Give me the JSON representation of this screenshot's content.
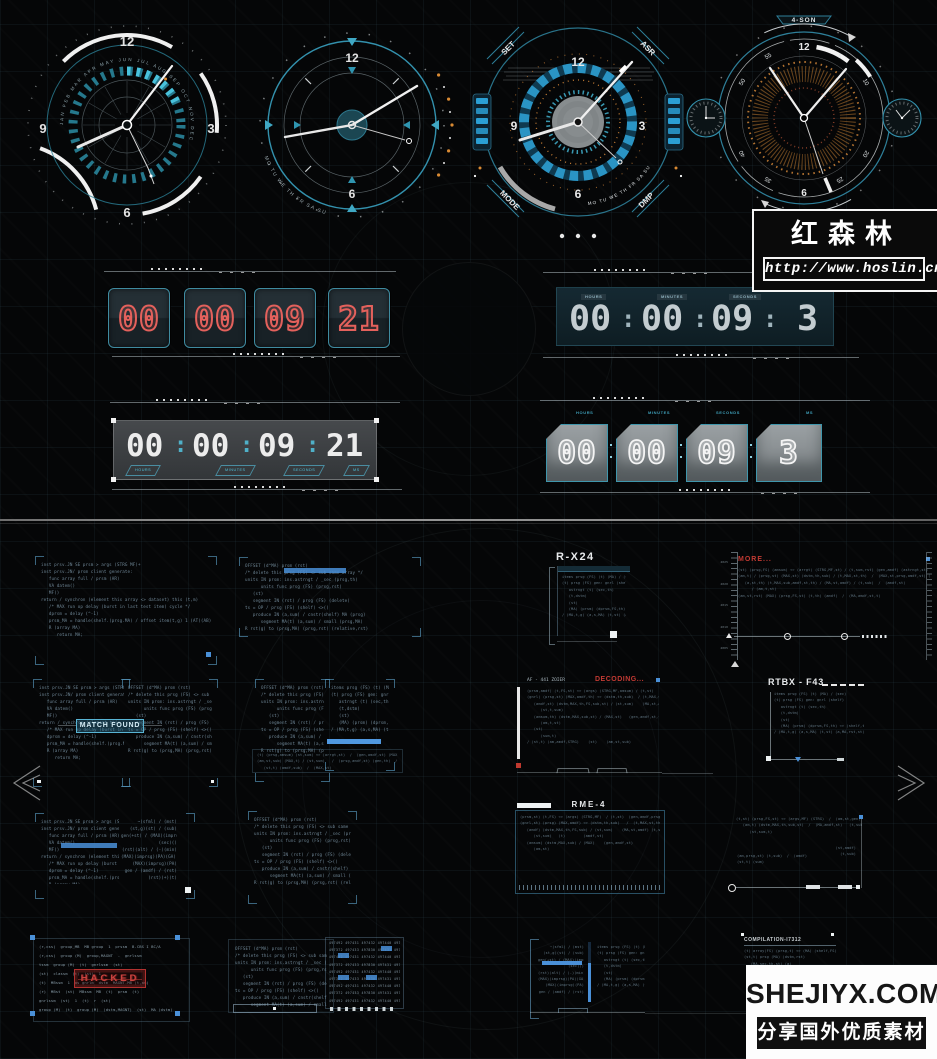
{
  "colors": {
    "accent_teal": "#35a0bc",
    "accent_blue": "#4a90d8",
    "digit_red": "#e4615c",
    "title_red": "#c23a33",
    "panel_border": "#2e6e8e",
    "background": "#050607"
  },
  "watermark_hoslin": {
    "title": "红森林",
    "url": "http://www.hoslin.cn/"
  },
  "watermark_shejiyx": {
    "site": "SHEJIYX.COM",
    "tagline": "分享国外优质素材"
  },
  "clocks": {
    "c1": {
      "n12": "12",
      "n3": "3",
      "n6": "6",
      "n9": "9",
      "months": "JAN FEB MAR APR MAY JUN JUL AUG SEP OCT NOV DEC"
    },
    "c2": {
      "n12": "12",
      "n6": "6",
      "days": "MO TU WE TH FR SA SU"
    },
    "c3": {
      "n12": "12",
      "n3": "3",
      "n6": "6",
      "n9": "9",
      "tab_tl": "SET",
      "tab_tr": "ASR",
      "tab_bl": "MODE",
      "tab_br": "DMP",
      "days": "MO TU WE TH FR SA SU"
    },
    "c4": {
      "top": "4-SON",
      "bottom": "AUTO WGT",
      "n12": "12",
      "n6": "6",
      "m5": "5",
      "m10": "10",
      "m20": "20",
      "m25": "25",
      "m35": "35",
      "m40": "40",
      "m50": "50",
      "m55": "55"
    }
  },
  "timers": {
    "flip_red": {
      "d1": "00",
      "d2": "00",
      "d3": "09",
      "d4": "21"
    },
    "digital_teal": {
      "l1": "HOURS",
      "l2": "MINUTES",
      "l3": "SECONDS",
      "d1": "00",
      "d2": "00",
      "d3": "09",
      "d4": "3",
      "colon": ":"
    },
    "digital_gray": {
      "l1": "HOURS",
      "l2": "MINUTES",
      "l3": "SECONDS",
      "l4": "MS",
      "d1": "00",
      "d2": "00",
      "d3": "09",
      "d4": "21",
      "colon": ":"
    },
    "flip_gray": {
      "l1": "HOURS",
      "l2": "MINUTES",
      "l3": "SECONDS",
      "l4": "MS",
      "d1": "00",
      "d2": "00",
      "d3": "09",
      "d4": "3"
    }
  },
  "labels": {
    "rx24": "R-X24",
    "more": "MORE...",
    "match": "MATCH FOUND",
    "af": "AF - 441 ZOIER",
    "decoding": "DECODING...",
    "rtbx": "RTBX - F43",
    "rme": "RME-4",
    "comp": "COMPILATION-I7312",
    "hacked": "HACKED"
  },
  "ruler": {
    "labels": [
      "4025",
      "4020",
      "4015",
      "4010",
      "4005"
    ]
  },
  "code": {
    "a": [
      "inst prsv.JN SE prsm > args (STRG MF)+",
      "inst prsv.JN/ prsm client generate:",
      "   func array full / prsm (AR)",
      "   VA datem()",
      "   MF()",
      "return / synchron (element this array <> dataset) this (t,m)",
      "   /* MAX run op delay (burst in last test item) cycle */",
      "   dprsm = delay (^-1)",
      "   prsm_MA = handle(shelf.(prsg.MA) / offset item(t,g) 1 (AT)(AB)",
      "   R (array MA)",
      "      return MA;"
    ],
    "b": [
      "OFFSET (d^MA) prsm (rst)",
      "/* delete this prsg (FS) <> sub same array */",
      "units IN prsm: ins.astrngt / _sec (prsg,th)",
      "      units func prsg (FS) (prsg,rst)",
      "   (st)",
      "   segment IN (rst) / prsg (FS) (delete)",
      "ts = OP / prsg (FS) (shelf) <>()",
      "   produce IN (a,sum) / cnstr(shelf) MA (prsg)",
      "      segment MA(t) (a,sum) / small (prsg,MA)",
      "R rst(g) to (prsg,MA) (prsg,rst) (relative,rst)"
    ],
    "c": [
      "items prsg (FS) (t) (MA) / (sec)",
      "(t) prsg (FS) gen: gnrl (shelf)",
      "   astrngt (t) (sec,th)",
      "   (t,dstm)",
      "   (st)",
      "   (MA) (prsm) (dprsm,FS,th) <> (shelf,th,rst)",
      "/ (MA,t,g) (a,s,MA) (t,st) (a,MA,rst,st)"
    ],
    "d": [
      "(t) array(FS) (prsg,t) <> (MA) (shelf,FS)",
      "(st,t) prsg (MA) (dstm,rst)",
      "   (MA,sec,th,st) (a)",
      "   (dstm)",
      "   (t)"
    ],
    "right": [
      "~(sfml) / (mst)",
      "(st,g)(st) / (sub)",
      "gen(+st) / (MAX)(imprsg)(PA",
      "(sec)()",
      "(rst)(alt) / (-)(min)",
      "(MAX)(imprsg)(PA)(GA) / (rst)",
      "(MAX)(imprsg)(PA)",
      "gen / (amdf) / (rst)",
      "(rst)(+)(t)"
    ],
    "long_more": [
      "(st) (prsg,FS) (amsum) <> (arrgt) (STRG,MF,st) / (t,sum,rst) (gen,amdf) (astrngt,st)  (prsg,FS,amsum,st) (t)  /  (amdf,st)",
      "(am,t) / (prsg,st) (MAX,st) (dstm,th,sub) / (t,MAX,st,th)  /  (MAX,st,prsg,amdf,st) (gen,th,sub,st) (t) /",
      "   (a,st,th) (t,MAX,sub,amdf,st,th) / (MA,st,amdf) / (t,sub)  /  (amdf,st)",
      "      / (am,t,st)",
      "(am,st,rst) (MAX) (prsg,FS,st) (t,th) (amdf)  /  (MA,amdf,st,t)"
    ],
    "long_decode": [
      "(prsm,amdf) (t,FS,st) <> (args) (STRG,MF,amsum) / (t,st)  (gen,amdf,prsg)  (astrngt,st,MA)    (amdf)    (t)",
      "(gnrl) (prsg,st) (MAX,amdf,th) <> (dstm,th,sub)  / (t,MAX,st,th)  (MAX,st,prsg,amdf) (gen,th,sub) (t) /",
      "   (amdf,st) (dstm,MAX,th,FS,sub,st) / (st,sum)    (MA,st,amdf) (t,sub)",
      "      (st,t,sum)",
      "   (amsum,th) (dstm,MAX,sub,st) / (MAX,st)   (gen,amdf,st,th)   (prsg,FS,st,amdf,MA)",
      "      (am,t,st)",
      "   (st)",
      "      (sum,t)",
      "/ (st,t) (am,amdf,STRG)    (st)    (am,st,sub)"
    ],
    "long_rme": [
      "(prsm,st) (t,FS) <> (args) (STRG,MF)  / (t,st)  (gen,amdf,prsg)  (astrngt,st)     (amdf)    (t)",
      "(gnrl,st) (prsg) (MAX,amdf) <> (dstm,th,sub)   /  (t,MAX,st,th) (MAX,st,prsg,amdf) (gen,th,sub) /",
      "   (amdf) (dstm,MAX,th,FS,sub) / (st,sum)    (MA,st,amdf) (t,sub)",
      "      (st,sum)   (t)        (amdf,st)",
      "   (amsum) (dstm,MAX,sub) / (MAX)    (gen,amdf,st)",
      "      (am,st)"
    ],
    "footer": [
      "(t) (prsg,amsum) (st,sum) <> (arrgt,st)  /  (gen,amdf,st) (MAX,prsg) (t,th)  /  (sub,st) (amdf)  /  (gen,st)",
      "(am,st,sub) (MAX,t) / (st,sum)   /  (prsg,amdf,st) (gen,th)  / (MAX,st,amdf,th) (t,sub,st) (amdf)",
      "   (st,t) (amdf,sub)  /  (MAX,st)"
    ],
    "p13_top": [
      "(t,st) (prsg,FS,st) <> (args,MF) (STRG)  /  (am,st,gen) (amdf,prsg,st) (astrngt,MA,st) (t,th,sub) (st) /",
      "   (am,t) (dstm,MAX,th,sub,st)  /  (MA,amdf,st)   (t,sub,st)   (gen,amdf)",
      "      (st,sum,t)"
    ],
    "p13_note": [
      "(st,amdf)",
      "(t,sub)"
    ],
    "p13_bottom": [
      "(am,prsg,st) (t,sub)  /  (amdf)",
      "(st,t) (sum)"
    ]
  },
  "hexdump": {
    "rows": [
      "497492 497431 497432 497440 493426 497435",
      "497372 497433 497830 497431 497426 497435",
      "497492 497431 497432 497440 493426 497435",
      "497372 497433 497830 497431 497426 497435",
      "497492 497431 497432 497440 493426 497435",
      "497372 497433 497830 497431 497426 497435",
      "497492 497431 497432 497440 493426 497435",
      "497372 497433 497830 497431 497426 497435",
      "497492 497431 497432 497440 493426 497435"
    ]
  },
  "table": {
    "rows": [
      "(r,css)  group_MB  MB group  1  prssm  B.CBS I BC/A",
      "(r,css)  group (M)  group,MAGNT  -  gnrlssm",
      "tssm  group (M)  (t)  gnrlssm  (st)",
      "(st)  classm  (t)  (st)  1",
      "(t)  MBssm  1  as gnrlm  dstm  MAGNT-MB (t,am)",
      "(r)  MBst  (st)  MBssm  MB  (t)  prsm  (t)",
      "gnrlssm  (st)  1  (t)  r  (st)",
      "group (M)  (t)  group (M)  (dstm,MAGNT)  (st)  MA (dstm)"
    ]
  }
}
